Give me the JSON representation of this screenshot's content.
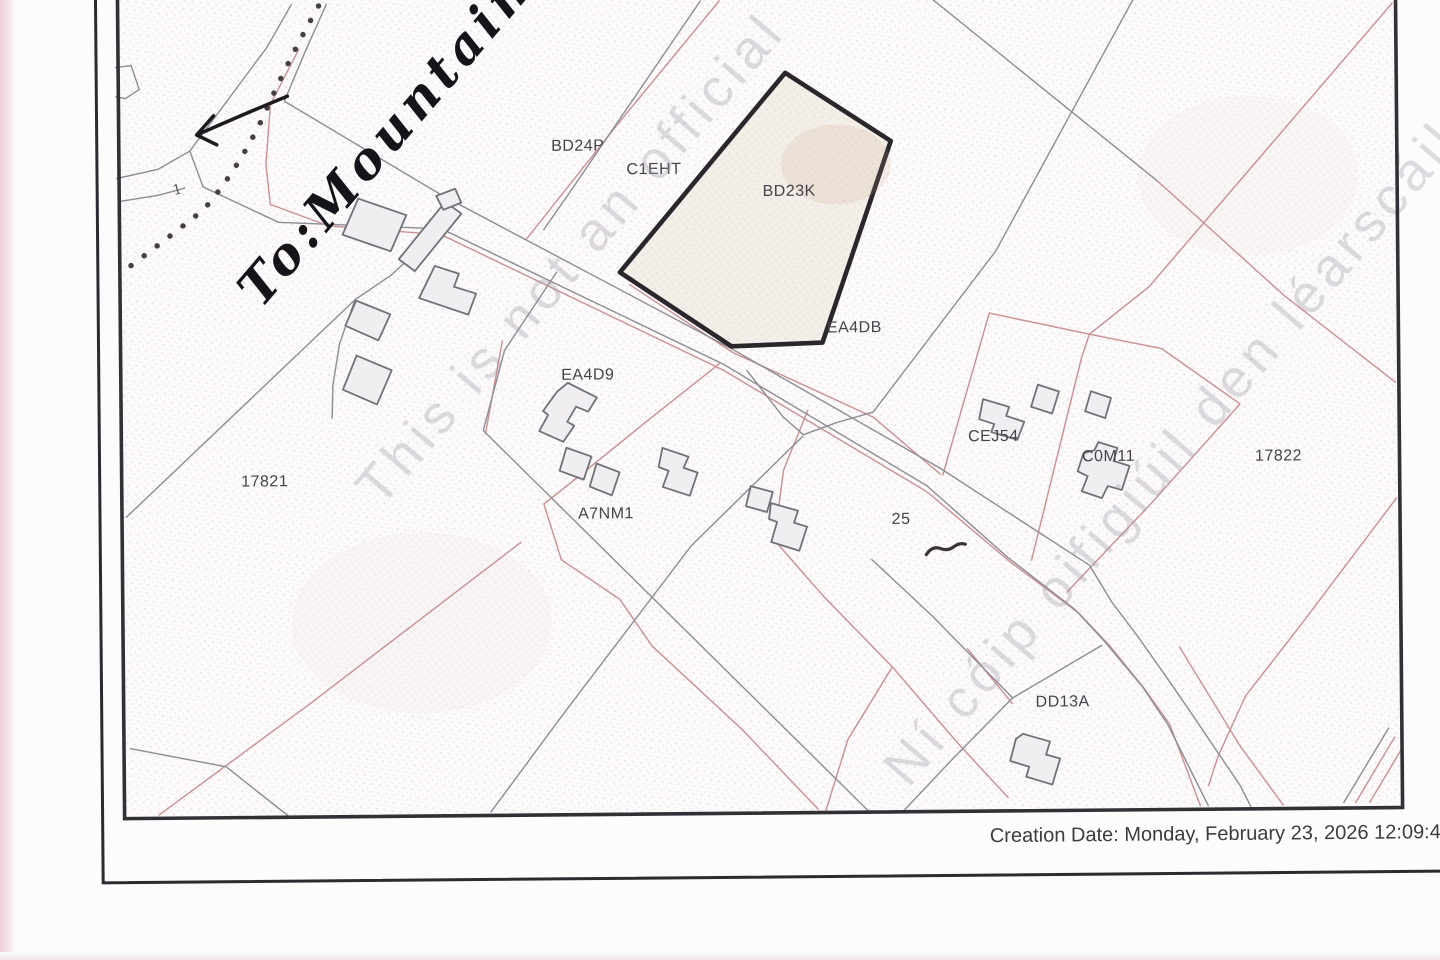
{
  "footer": {
    "creation_date": "Creation Date: Monday, February 23, 2026 12:09:49"
  },
  "annotations": {
    "handwritten_destination": "To:Mountain",
    "handwritten_numeral": "1"
  },
  "watermarks": {
    "left_diagonal": "This is not an official",
    "right_diagonal": "Ní cóip oifigiúil den léarscáil"
  },
  "map": {
    "highlighted_parcel": "BD23K",
    "labels": [
      {
        "text": "BD24P"
      },
      {
        "text": "C1EHT"
      },
      {
        "text": "BD23K"
      },
      {
        "text": "EA4DB"
      },
      {
        "text": "EA4D9"
      },
      {
        "text": "A7NM1"
      },
      {
        "text": "17821"
      },
      {
        "text": "CEJ54"
      },
      {
        "text": "C0M11"
      },
      {
        "text": "17822"
      },
      {
        "text": "25"
      },
      {
        "text": "DD13A"
      }
    ]
  },
  "colors": {
    "boundary_red": "#c99093",
    "line_gray": "#8d8d94",
    "frame_dark": "#313036",
    "label_ink": "#45444a",
    "highlight_stroke": "#29272b",
    "halftone_dot": "#d8cbd2"
  }
}
